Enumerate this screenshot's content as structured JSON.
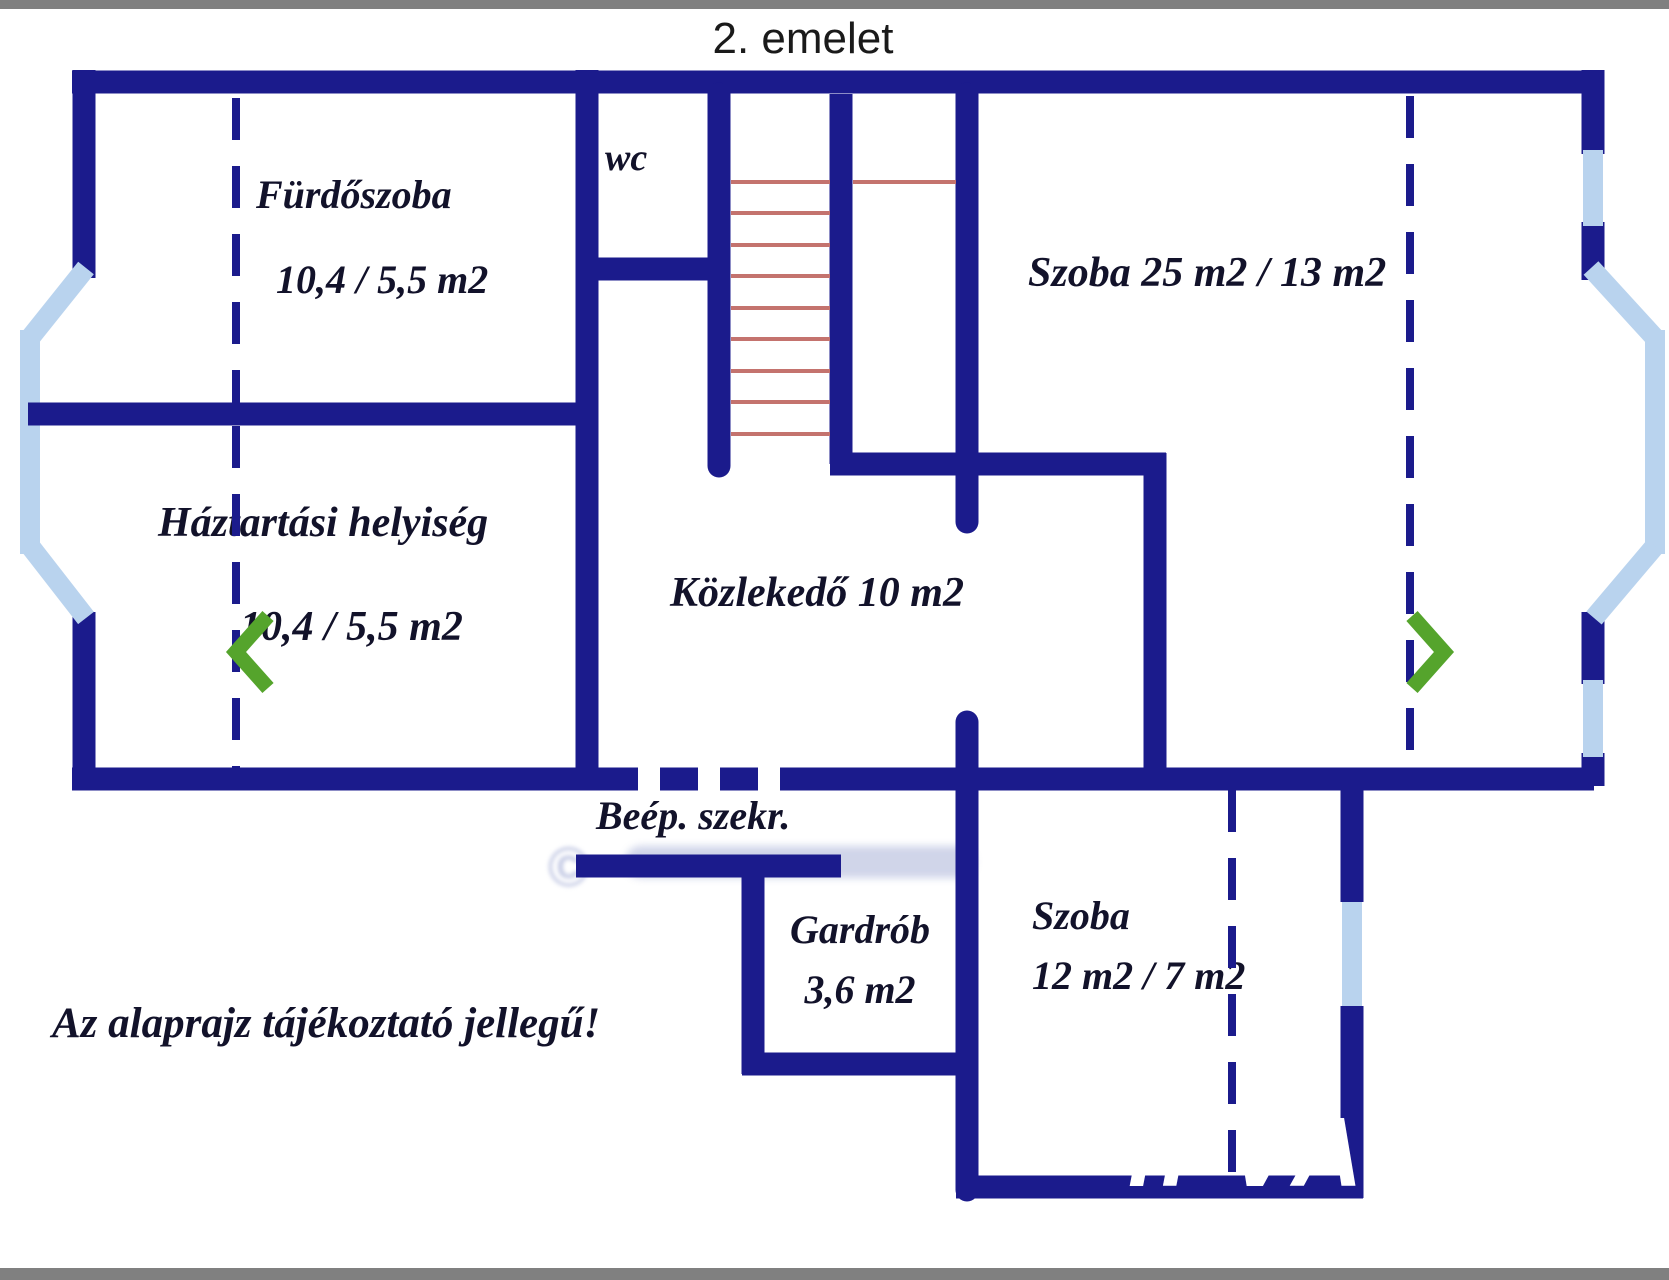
{
  "title": "2. emelet",
  "note": "Az alaprajz tájékoztató jellegű!",
  "rooms": {
    "furdoszoba": {
      "name": "Fürdőszoba",
      "area": "10,4 / 5,5 m2"
    },
    "wc": {
      "name": "wc"
    },
    "szoba25": {
      "name": "Szoba 25 m2 / 13 m2"
    },
    "haztartasi": {
      "name": "Háztartási helyiség",
      "area": "10,4 / 5,5 m2"
    },
    "kozlekedo": {
      "name": "Közlekedő 10 m2"
    },
    "beep_szekreny": {
      "name": "Beép. szekr."
    },
    "gardrob": {
      "name": "Gardrób",
      "area": "3,6 m2"
    },
    "szoba12": {
      "name": "Szoba",
      "area": "12 m2 / 7 m2"
    }
  },
  "icons": {
    "prev": "chevron-left",
    "next": "chevron-right"
  },
  "watermarks": {
    "copyright": "©",
    "corner": "il VA"
  },
  "palette": {
    "wall": "#1b1b8c",
    "window": "#b9d3ee",
    "stair_tread": "#c4736e",
    "nav_green": "#55a42c",
    "label_ink": "#12122a",
    "title_ink": "#1a1a1a",
    "frame_gray": "#808080",
    "watermark_lavender": "rgba(148,158,206,0.55)",
    "watermark_white": "#ffffff"
  }
}
